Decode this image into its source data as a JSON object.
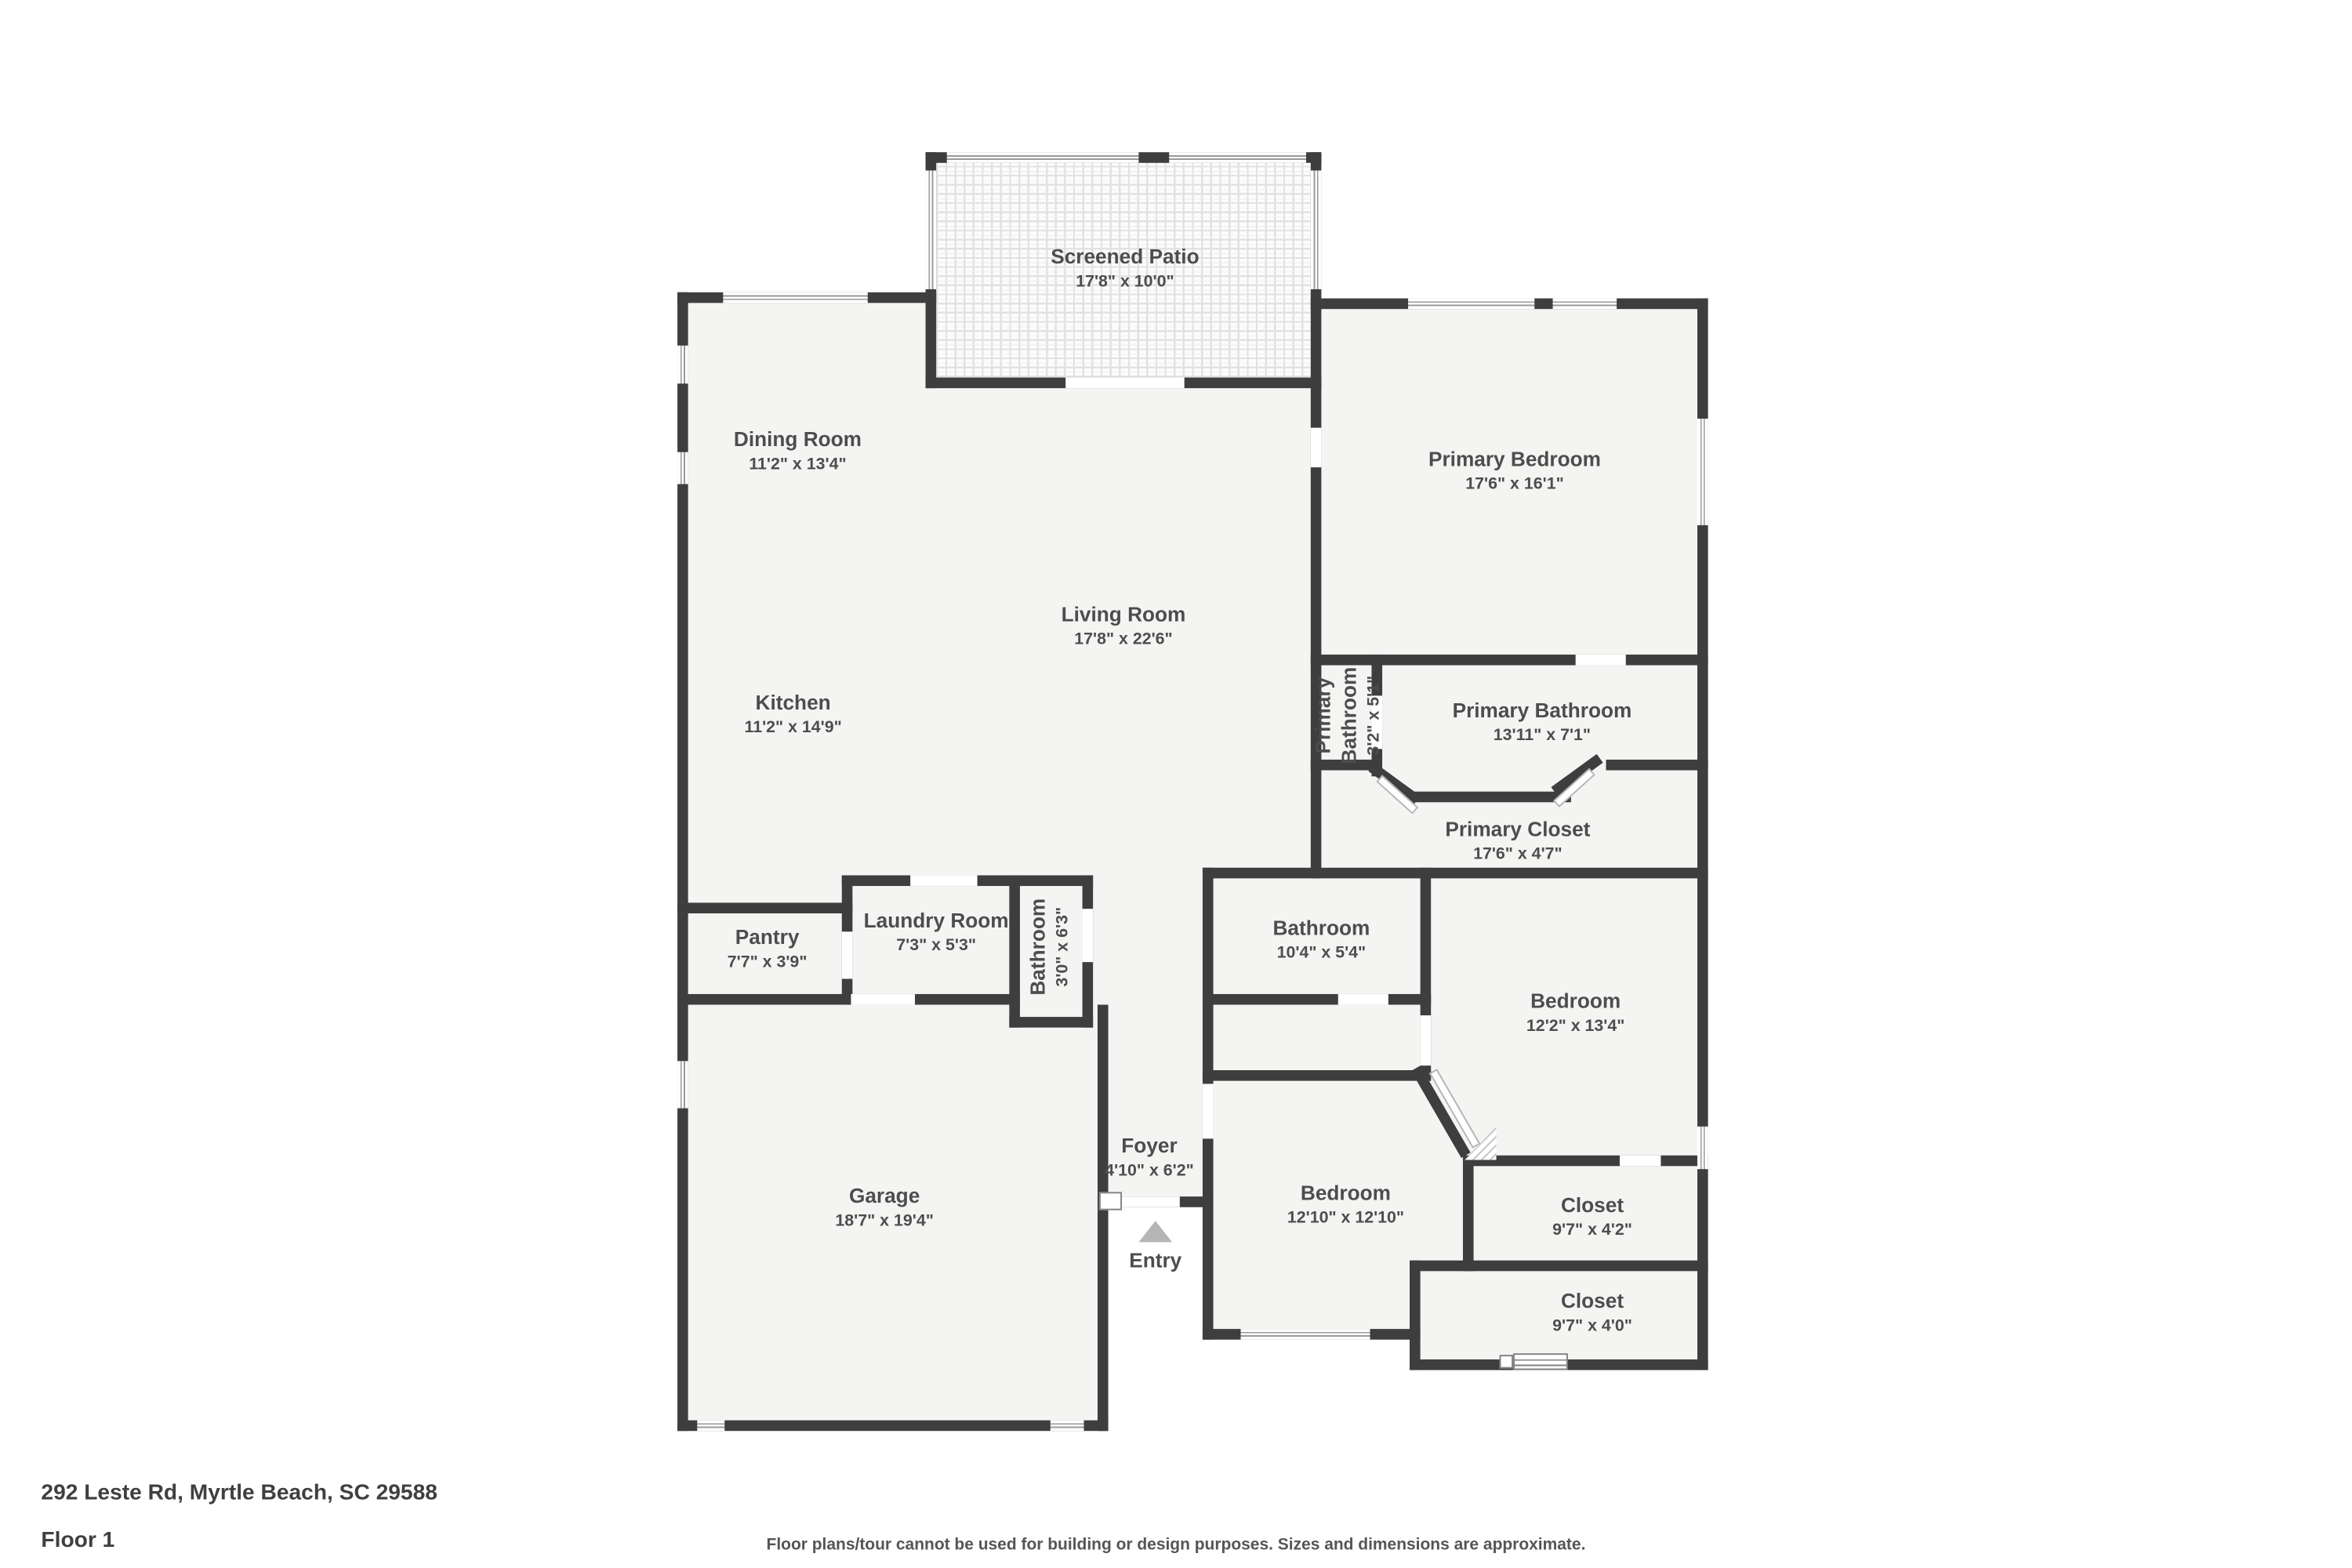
{
  "footer": {
    "address": "292 Leste Rd, Myrtle Beach, SC 29588",
    "floor": "Floor 1",
    "disclaimer": "Floor plans/tour cannot be used for building or design purposes. Sizes and dimensions are approximate."
  },
  "entry_label": "Entry",
  "rooms": [
    {
      "name": "Screened Patio",
      "dims": "17'8\" x 10'0\""
    },
    {
      "name": "Dining Room",
      "dims": "11'2\" x 13'4\""
    },
    {
      "name": "Primary Bedroom",
      "dims": "17'6\" x 16'1\""
    },
    {
      "name": "Living Room",
      "dims": "17'8\" x 22'6\""
    },
    {
      "name": "Kitchen",
      "dims": "11'2\" x 14'9\""
    },
    {
      "name": "Primary Bathroom",
      "dims": "3'2\" x 5'1\""
    },
    {
      "name": "Primary Bathroom",
      "dims": "13'11\" x 7'1\""
    },
    {
      "name": "Primary Closet",
      "dims": "17'6\" x 4'7\""
    },
    {
      "name": "Pantry",
      "dims": "7'7\" x 3'9\""
    },
    {
      "name": "Laundry Room",
      "dims": "7'3\" x 5'3\""
    },
    {
      "name": "Bathroom",
      "dims": "3'0\" x 6'3\""
    },
    {
      "name": "Bathroom",
      "dims": "10'4\" x 5'4\""
    },
    {
      "name": "Bedroom",
      "dims": "12'2\" x 13'4\""
    },
    {
      "name": "Foyer",
      "dims": "4'10\" x 6'2\""
    },
    {
      "name": "Garage",
      "dims": "18'7\" x 19'4\""
    },
    {
      "name": "Bedroom",
      "dims": "12'10\" x 12'10\""
    },
    {
      "name": "Closet",
      "dims": "9'7\" x 4'2\""
    },
    {
      "name": "Closet",
      "dims": "9'7\" x 4'0\""
    }
  ],
  "colors": {
    "wall": "#3e3e3e",
    "room_fill": "#f4f4f3",
    "text": "#4d4d4d",
    "entry_arrow": "#b5b5b5"
  }
}
